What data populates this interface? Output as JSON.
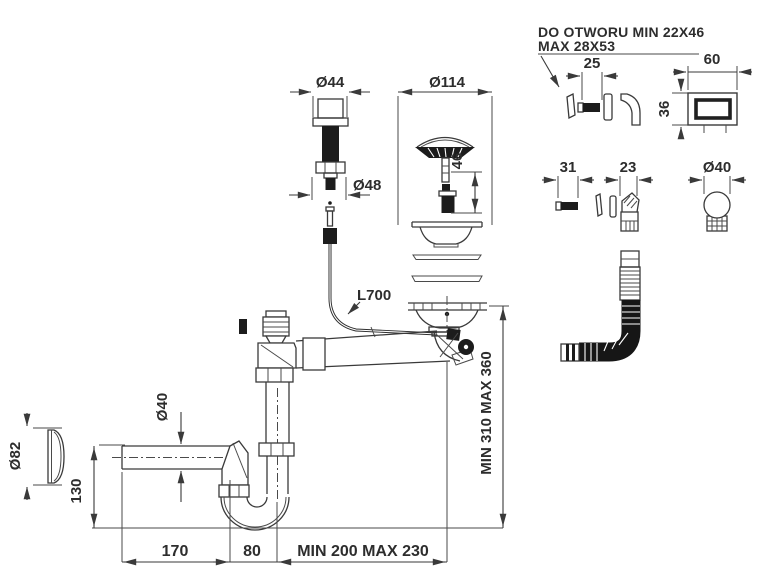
{
  "note": {
    "line1": "DO OTWORU MIN 22X46",
    "line2": "MAX 28X53"
  },
  "dimensions": {
    "popup_knob_diameter": "Ø44",
    "strainer_diameter": "Ø114",
    "knob_thread_diameter": "Ø48",
    "plug_length": "46",
    "cable_length": "L700",
    "installation_height": "MIN 310 MAX 360",
    "cleanout_cover_diameter": "Ø82",
    "waste_pipe_diameter": "Ø40",
    "trap_depth": "130",
    "screw_length": "31",
    "overflow_elbow_width": "23",
    "overflow_ball_diameter": "Ø40",
    "overflow_clip_width": "25",
    "overflow_cover_width": "60",
    "overflow_cover_height": "36",
    "inlet_pipe_length": "170",
    "trap_offset": "80",
    "outlet_length": "MIN 200 MAX 230"
  },
  "colors": {
    "line": "#3a3a3a",
    "dark_fill": "#1c1c1c",
    "text": "#2d2d2d",
    "background": "#ffffff"
  }
}
